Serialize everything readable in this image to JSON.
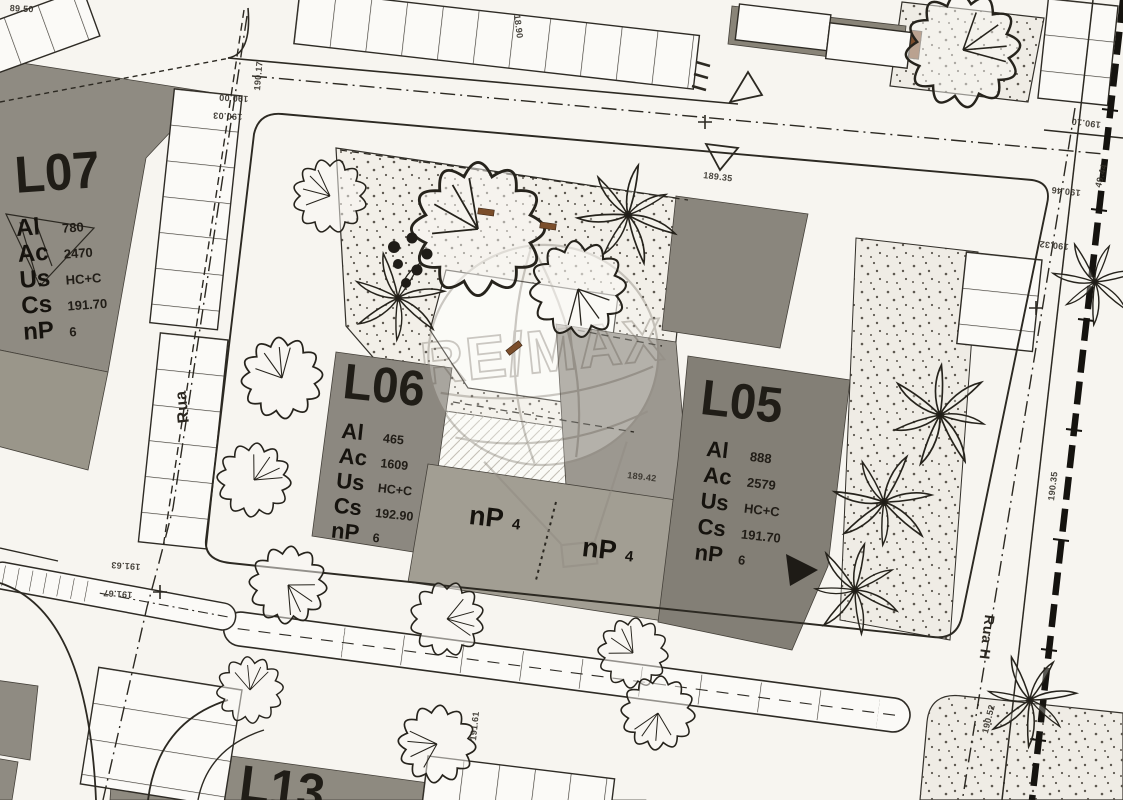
{
  "watermark_text": "RE/MAX",
  "streets": {
    "left_name": "Rua",
    "right_name": "Rua H"
  },
  "lots": {
    "l07": {
      "id": "L07",
      "rows": [
        {
          "k": "Al",
          "v": "780"
        },
        {
          "k": "Ac",
          "v": "2470"
        },
        {
          "k": "Us",
          "v": "HC+C"
        },
        {
          "k": "Cs",
          "v": "191.70"
        },
        {
          "k": "nP",
          "v": "6"
        }
      ]
    },
    "l06": {
      "id": "L06",
      "rows": [
        {
          "k": "Al",
          "v": "465"
        },
        {
          "k": "Ac",
          "v": "1609"
        },
        {
          "k": "Us",
          "v": "HC+C"
        },
        {
          "k": "Cs",
          "v": "192.90"
        },
        {
          "k": "nP",
          "v": "6"
        }
      ]
    },
    "l05": {
      "id": "L05",
      "rows": [
        {
          "k": "Al",
          "v": "888"
        },
        {
          "k": "Ac",
          "v": "2579"
        },
        {
          "k": "Us",
          "v": "HC+C"
        },
        {
          "k": "Cs",
          "v": "191.70"
        },
        {
          "k": "nP",
          "v": "6"
        }
      ]
    },
    "l13": {
      "id": "L13"
    }
  },
  "sub_lots": {
    "np4_a": {
      "k": "nP",
      "v": "4"
    },
    "np4_b": {
      "k": "nP",
      "v": "4"
    }
  },
  "spot_elevations": [
    "89.50",
    "18.90",
    "190.17",
    "190.00",
    "190.03",
    "189.35",
    "190.10",
    "49.44",
    "190.46",
    "190.32",
    "190.35",
    "189.42",
    "191.63",
    "191.67",
    "191.61",
    "190.52"
  ]
}
